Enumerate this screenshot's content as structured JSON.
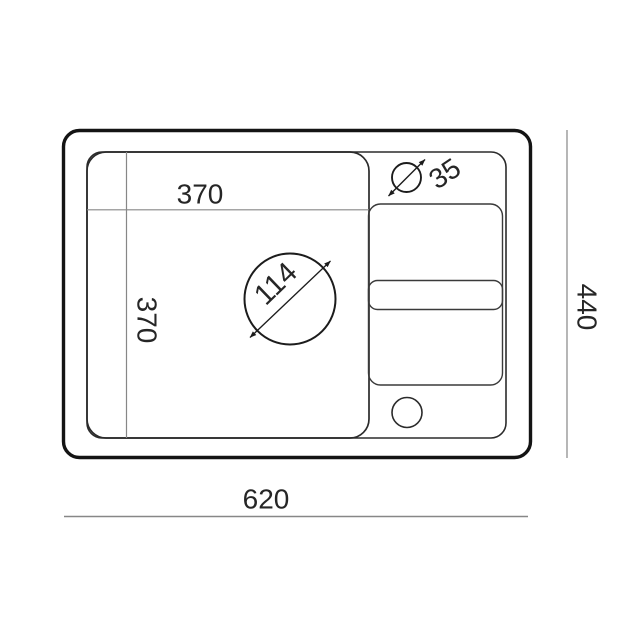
{
  "drawing": {
    "title": "sink-top-view-technical-drawing",
    "type": "dimensioned technical diagram",
    "units_shown": "mm (implied)",
    "colors": {
      "background": "#ffffff",
      "outer_edge_stroke": "#141414",
      "inner_line_stroke": "#2b2b2b",
      "detail_line_stroke": "#3a3a3a",
      "dimension_line": "#878787",
      "dimension_text": "#262626"
    },
    "labels": {
      "bowl_width": "370",
      "bowl_depth": "370",
      "bowl_opening_diameter": "114",
      "faucet_hole_diameter": "35",
      "overall_depth": "440",
      "overall_width": "620"
    }
  }
}
